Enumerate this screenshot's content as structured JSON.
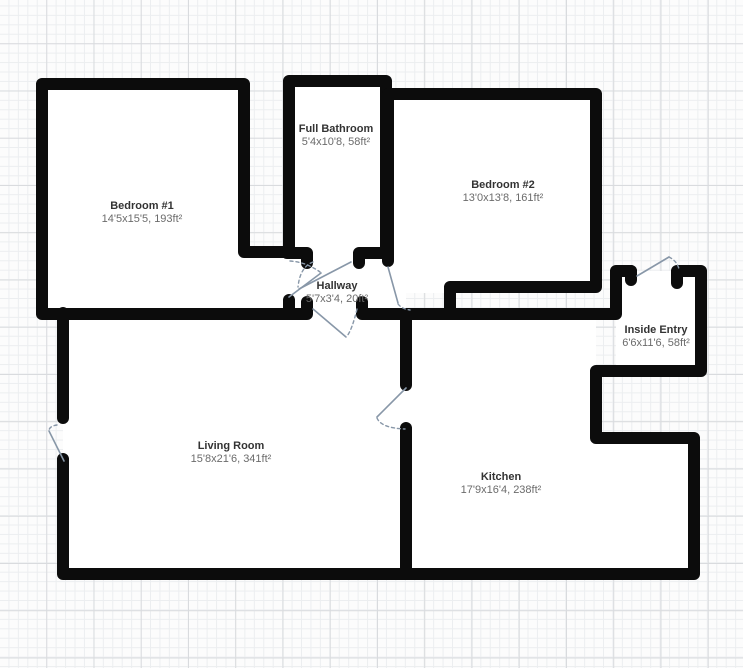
{
  "plan": {
    "title": "Floor Plan",
    "rooms": [
      {
        "id": "bedroom1",
        "name": "Bedroom #1",
        "dims": "14'5x15'5, 193ft²"
      },
      {
        "id": "bathroom",
        "name": "Full Bathroom",
        "dims": "5'4x10'8, 58ft²"
      },
      {
        "id": "bedroom2",
        "name": "Bedroom #2",
        "dims": "13'0x13'8, 161ft²"
      },
      {
        "id": "hallway",
        "name": "Hallway",
        "dims": "5'7x3'4, 20ft²"
      },
      {
        "id": "inside_entry",
        "name": "Inside Entry",
        "dims": "6'6x11'6, 58ft²"
      },
      {
        "id": "living_room",
        "name": "Living Room",
        "dims": "15'8x21'6, 341ft²"
      },
      {
        "id": "kitchen",
        "name": "Kitchen",
        "dims": "17'9x16'4, 238ft²"
      }
    ],
    "colors": {
      "wall": "#0c0c0c",
      "room_fill": "#ffffff",
      "door_line": "#8897a8",
      "grid_minor": "#eceef0",
      "grid_major": "#d9dbde",
      "background": "#fcfcfc",
      "room_name_text": "#333333",
      "room_dims_text": "#6b6b6b"
    }
  }
}
